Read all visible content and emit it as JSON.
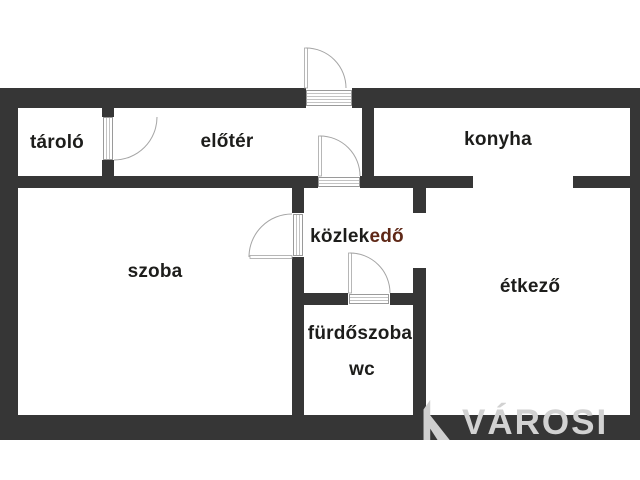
{
  "diagram_type": "floor-plan",
  "rooms": {
    "tarolo": {
      "label": "tároló"
    },
    "eloter": {
      "label": "előtér"
    },
    "konyha": {
      "label": "konyha"
    },
    "szoba": {
      "label": "szoba"
    },
    "kozlekedo": {
      "label_part1": "közlek",
      "label_part2": "edő"
    },
    "etkezo": {
      "label": "étkező"
    },
    "furdoszoba": {
      "label": "fürdőszoba"
    },
    "wc": {
      "label": "wc"
    }
  },
  "watermark": {
    "text": "VÁROSI",
    "logo_icon": "varosi-logo-icon"
  },
  "colors": {
    "wall": "#363636",
    "room_label": "#1d1d1b",
    "room_label_accent": "#5f2817",
    "door_line": "#a5a5a5",
    "door_threshold_stripe": "#c3c3c3",
    "watermark_gray": "#d2d2d2",
    "background": "#ffffff"
  }
}
